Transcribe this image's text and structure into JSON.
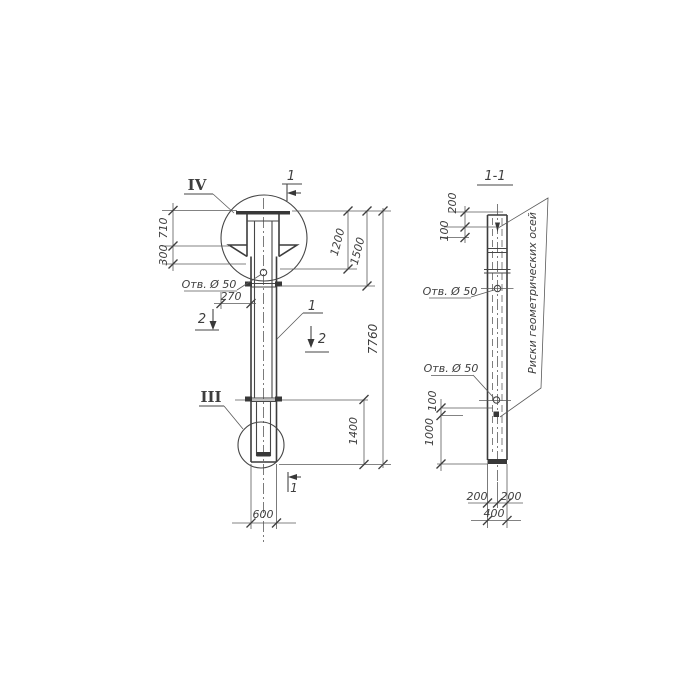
{
  "ink_color": "#414141",
  "left_view": {
    "detail_top_label": "IV",
    "detail_bottom_label": "III",
    "section_cut_top": "1",
    "section_cut_bottom": "1",
    "section_cut_left": "2",
    "section_cut_right": "2",
    "part_callout": "1",
    "hole_note": "Отв. Ø 50",
    "dim_710": "710",
    "dim_300": "300",
    "dim_270": "270",
    "dim_1200": "1200",
    "dim_1500": "1500",
    "dim_7760": "7760",
    "dim_1400": "1400",
    "dim_600": "600"
  },
  "right_view": {
    "section_title": "1-1",
    "hole_note_upper": "Отв. Ø 50",
    "hole_note_lower": "Отв. Ø 50",
    "axes_note": "Риски геометрических осей",
    "dim_200_top": "200",
    "dim_100_upper": "100",
    "dim_100_lower": "100",
    "dim_1000": "1000",
    "dim_200_bottom_left": "200",
    "dim_200_bottom_right": "200",
    "dim_400": "400"
  }
}
